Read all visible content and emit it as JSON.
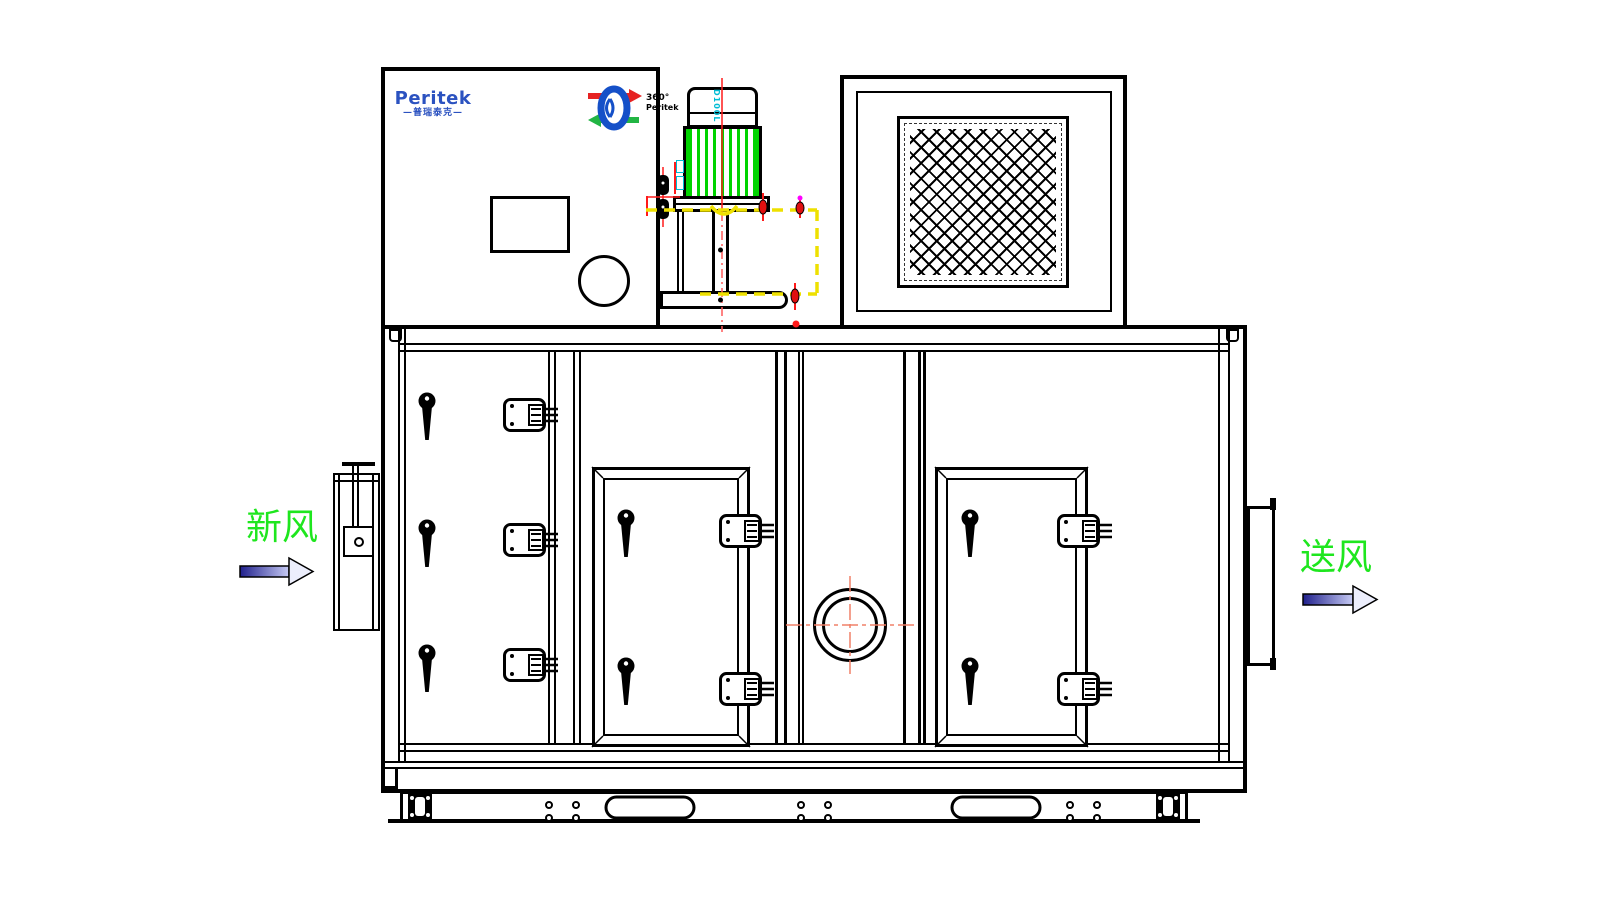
{
  "branding": {
    "logo_text": "Peritek",
    "logo_subtext": "—普瑞泰克—",
    "rotor_badge_line1": "360°",
    "rotor_badge_line2": "Peritek"
  },
  "labels": {
    "fresh_air": "新风",
    "supply_air": "送风",
    "motor_frame_label": "D100L"
  },
  "colors": {
    "line_black": "#000000",
    "logo_blue": "#2b52c0",
    "flow_text_green": "#1ee61e",
    "motor_fin_green": "#00d400",
    "annotation_red": "#ff1a1a",
    "annotation_yellow": "#eee000",
    "annotation_magenta": "#ff00ff",
    "motor_label_cyan": "#00bcd4",
    "arrow_dark": "#20208c",
    "arrow_light": "#c6caf4"
  },
  "icons": [
    "rotor-logo-icon",
    "fresh-air-arrow-icon",
    "supply-air-arrow-icon",
    "door-handle-icon",
    "door-hinge-icon",
    "latch-icon",
    "sight-glass",
    "filter-mesh",
    "forklift-slot",
    "bolt-hole",
    "foot-bracket"
  ]
}
